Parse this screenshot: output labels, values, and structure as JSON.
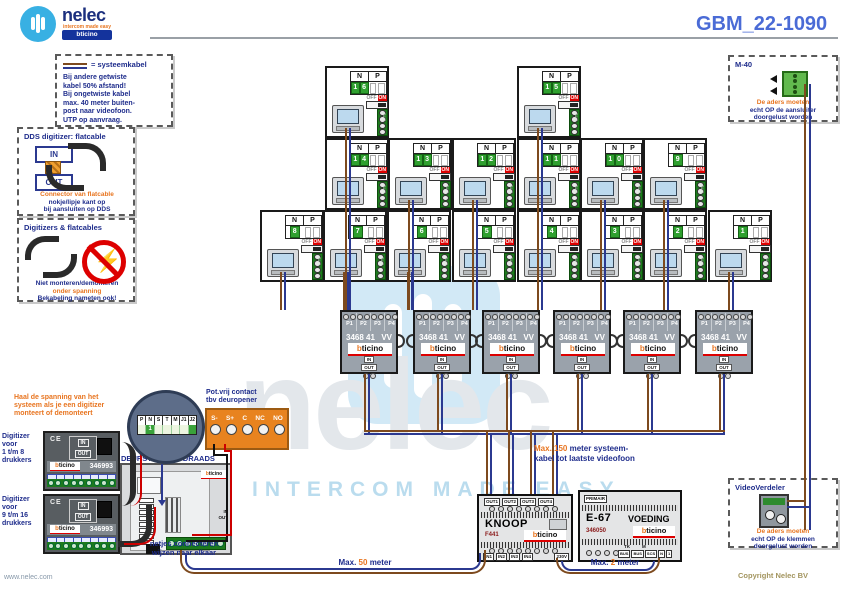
{
  "header": {
    "brand": "nelec",
    "brand_tagline": "intercom made easy",
    "partner": "bticino",
    "doc_number": "GBM_22-1090"
  },
  "brand": {
    "b": "b",
    "rest": "ticino"
  },
  "watermark": {
    "word": "nelec",
    "tagline": "INTERCOM MADE EASY"
  },
  "legend_box": {
    "title": "= systeemkabel",
    "lines": [
      "Bij andere getwiste",
      "kabel 50% afstand!",
      "Bij ongetwiste kabel",
      "max. 40 meter buiten-",
      "post naar videofoon.",
      "UTP op aanvraag."
    ]
  },
  "dds_box": {
    "title": "DDS digitizer: flatcable",
    "in_label": "IN",
    "out_label": "OUT",
    "note1": "Connector van flatcable",
    "note2": "nokje/lipje kant op",
    "note3": "bij aansluiten op DDS"
  },
  "digi_box": {
    "title": "Digitizers & flatcables",
    "note1": "Niet monteren/demonteren",
    "note2": "onder spanning",
    "note3": "Bekabeling nameten ook!"
  },
  "m40_box": {
    "label": "M-40",
    "note1": "De aders moeten",
    "note2": "echt OP de aansluiter",
    "note3": "doorgelust worden"
  },
  "verdeler_box": {
    "title": "VideoVerdeler",
    "note1": "De aders moeten",
    "note2": "echt OP de klemmen",
    "note3": "doorgelust worden"
  },
  "videofoon": {
    "n_header": "N",
    "p_header": "P",
    "off": "OFF",
    "on": "ON",
    "bus": "BUS",
    "units": [
      {
        "n": "16"
      },
      {
        "n": "15"
      },
      {
        "n": "14"
      },
      {
        "n": "13"
      },
      {
        "n": "12"
      },
      {
        "n": "11"
      },
      {
        "n": "10"
      },
      {
        "n": "9"
      },
      {
        "n": "8"
      },
      {
        "n": "7"
      },
      {
        "n": "6"
      },
      {
        "n": "5"
      },
      {
        "n": "4"
      },
      {
        "n": "3"
      },
      {
        "n": "2"
      },
      {
        "n": "1"
      }
    ]
  },
  "distributor": {
    "model": "3468 41",
    "suffix": "VV",
    "ports": [
      "P1",
      "P2",
      "P3",
      "P4"
    ],
    "in": "IN",
    "out": "OUT"
  },
  "knoop": {
    "title": "KNOOP",
    "model": "F441",
    "outputs": [
      "OUT1",
      "OUT2",
      "OUT3",
      "OUT4"
    ],
    "inputs": [
      "IN1",
      "IN2",
      "IN3",
      "IN4"
    ],
    "mains": "230V"
  },
  "e67": {
    "primair": "PRIMAIR",
    "title": "E-67",
    "subtitle": "VOEDING",
    "model": "346050",
    "tk": "TK",
    "m": "M",
    "terminals": [
      "BUS",
      "BUS",
      "SCS",
      "N",
      "1"
    ]
  },
  "deurstation": {
    "title": "DEURSTATION 2-DRAADS",
    "in": "IN",
    "out": "OUT"
  },
  "configurator": {
    "labels": [
      "P",
      "N",
      "S",
      "T",
      "M",
      "J1",
      "J2"
    ],
    "value": "1"
  },
  "potvrij": {
    "title1": "Pot.vrij contact",
    "title2": "tbv deuropener",
    "terminals": [
      "S-",
      "S+",
      "C",
      "NC",
      "NO"
    ]
  },
  "digitizers": {
    "warning1": "Haal de spanning van het",
    "warning2": "systeem als je een digitizer",
    "warning3": "monteert of demonteert",
    "note1": "netjes connecteren",
    "note2": "wijzen naar elkaar",
    "units": [
      {
        "label1": "Digitizer",
        "label2": "voor",
        "label3": "1 t/m 8",
        "label4": "drukkers",
        "model": "346993",
        "ce": "CE"
      },
      {
        "label1": "Digitizer",
        "label2": "voor",
        "label3": "9 t/m 16",
        "label4": "drukkers",
        "model": "346993",
        "ce": "CE"
      }
    ]
  },
  "annotations": {
    "max150_hl": "Max. 150",
    "max150_rest": " meter systeem-",
    "max150_l2": "kabel tot laatste videofoon",
    "max50_pre": "Max.",
    "max50_num": "50",
    "max50_post": "meter",
    "max2_pre": "Max.",
    "max2_num": "2",
    "max2_post": "meter"
  },
  "footer": {
    "website": "www.nelec.com",
    "copyright": "Copyright Nelec BV"
  }
}
